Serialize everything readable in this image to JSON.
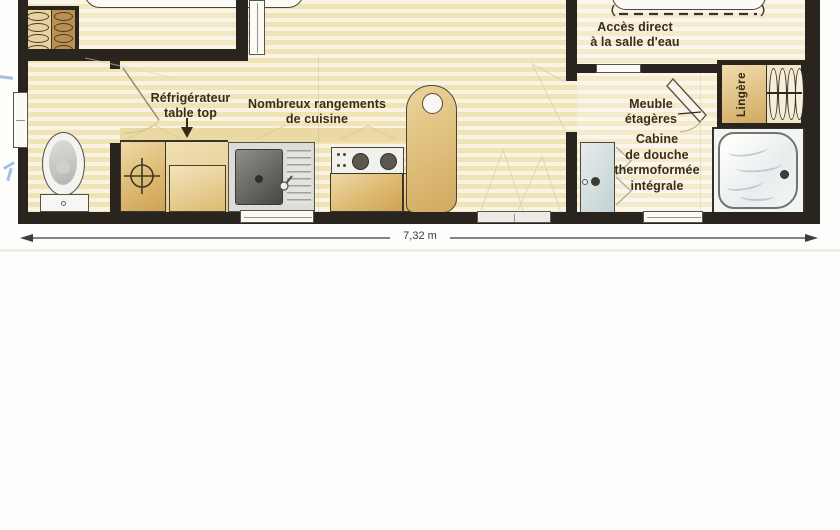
{
  "plan": {
    "dimension_label": "7,32 m",
    "labels": {
      "refrigerator": {
        "line1": "Réfrigérateur",
        "line2": "table top"
      },
      "kitchen_storage": {
        "line1": "Nombreux rangements",
        "line2": "de cuisine"
      },
      "bathroom_access": {
        "line1": "Accès direct",
        "line2": "à la salle d'eau"
      },
      "shelf_unit": {
        "line1": "Meuble",
        "line2": "étagères"
      },
      "shower_cabin": {
        "line1": "Cabine",
        "line2": "de douche",
        "line3": "thermoformée",
        "line4": "intégrale"
      },
      "linen_closet": "Lingère"
    },
    "colors": {
      "wall": "#29241e",
      "floor_cream": "#f8f3e2",
      "floor_stripe": "#f0e3b6",
      "cabinet_tan": "#d9b267",
      "label_text": "#3a2c17",
      "shower_wave": "#b7c3c9",
      "pen_mark_blue": "#7ba6d6"
    }
  }
}
